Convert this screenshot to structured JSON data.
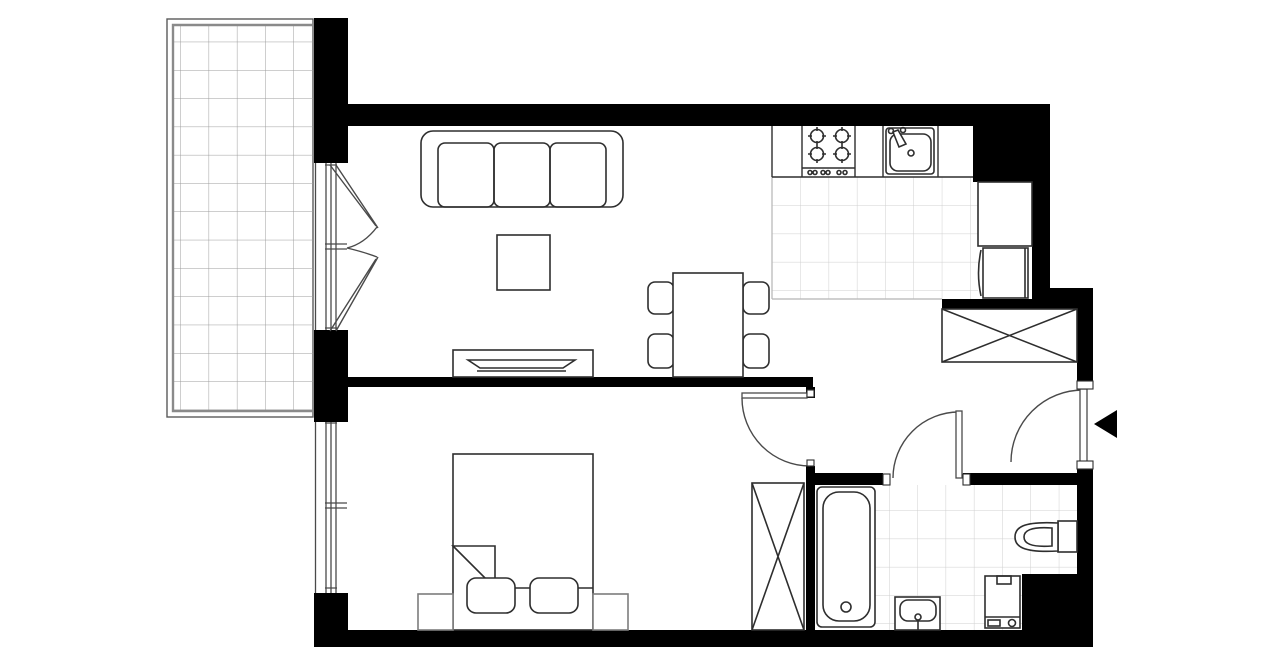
{
  "page": {
    "title": "One-bedroom apartment floor plan",
    "type": "architectural-floor-plan",
    "canvas_width": 1280,
    "canvas_height": 667
  },
  "colors": {
    "background": "#ffffff",
    "walls": "#000000",
    "furniture_outline": "#2e2e2e",
    "light_outline": "#7d7d7d",
    "frame_outline": "#4a4a4a",
    "tile_grid": "#cfcfcf",
    "balcony_grid": "#9c9c9c",
    "tile_border": "#b5b5b5"
  },
  "rooms": [
    {
      "id": "balcony",
      "name": "balcony",
      "floor": "tile-grid",
      "items": [
        "french-balcony-doors"
      ]
    },
    {
      "id": "living-dining",
      "name": "living-dining-area",
      "floor": "plain",
      "items": [
        "three-seat-sofa",
        "coffee-table",
        "tv-stand-with-tv",
        "dining-table",
        "four-dining-chairs"
      ]
    },
    {
      "id": "kitchen",
      "name": "open-kitchen",
      "floor": "tile-grid",
      "items": [
        "countertop",
        "four-burner-cooktop",
        "kitchen-sink",
        "tall-cabinet",
        "fridge-cabinet"
      ]
    },
    {
      "id": "hallway",
      "name": "entrance-hall",
      "floor": "plain",
      "items": [
        "built-in-wardrobe-x-symbol",
        "entrance-door"
      ]
    },
    {
      "id": "bedroom",
      "name": "bedroom",
      "floor": "plain",
      "items": [
        "double-bed",
        "two-pillows",
        "two-nightstands",
        "built-in-wardrobe-x-symbol",
        "window"
      ]
    },
    {
      "id": "bathroom",
      "name": "bathroom",
      "floor": "tile-grid",
      "items": [
        "bathtub",
        "washbasin",
        "washing-machine",
        "toilet"
      ]
    }
  ],
  "doors": [
    {
      "id": "entrance-door",
      "location": "right-exterior-wall",
      "swing": "quarter-arc-inward",
      "marker": "left-pointing-solid-triangle"
    },
    {
      "id": "bedroom-door",
      "location": "hall-to-bedroom",
      "swing": "quarter-arc-into-bedroom"
    },
    {
      "id": "bathroom-door",
      "location": "hall-to-bathroom",
      "swing": "quarter-arc-into-hall"
    },
    {
      "id": "balcony-french-doors",
      "location": "living-room-to-balcony",
      "leaves": 2
    }
  ],
  "windows": [
    {
      "id": "bedroom-window",
      "location": "left-exterior-wall",
      "panes": "double-line-frame-with-center-mullion"
    }
  ]
}
